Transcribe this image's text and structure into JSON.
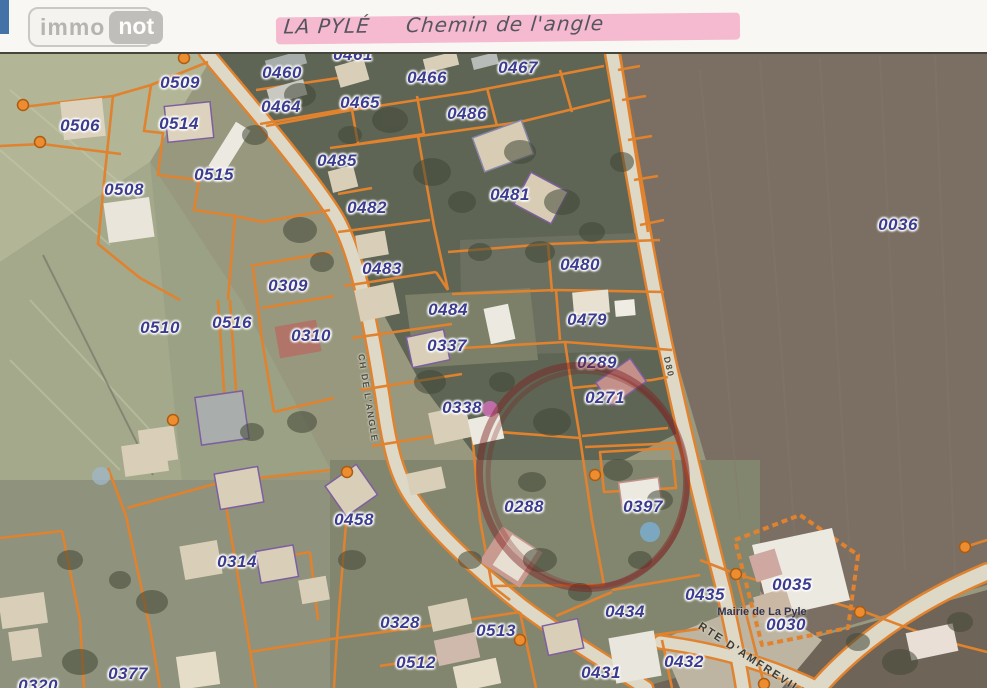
{
  "header": {
    "logo_immo": "immo",
    "logo_not": "not",
    "handwriting_left": "LA PYLÉ",
    "handwriting_right": "Chemin de l'angle"
  },
  "map": {
    "parcel_labels": [
      {
        "id": "0461",
        "x": 353,
        "y": 55
      },
      {
        "id": "0509",
        "x": 180,
        "y": 83
      },
      {
        "id": "0460",
        "x": 282,
        "y": 73
      },
      {
        "id": "0464",
        "x": 281,
        "y": 107
      },
      {
        "id": "0506",
        "x": 80,
        "y": 126
      },
      {
        "id": "0514",
        "x": 179,
        "y": 124
      },
      {
        "id": "0465",
        "x": 360,
        "y": 103
      },
      {
        "id": "0466",
        "x": 427,
        "y": 78
      },
      {
        "id": "0467",
        "x": 518,
        "y": 68
      },
      {
        "id": "0486",
        "x": 467,
        "y": 114
      },
      {
        "id": "0485",
        "x": 337,
        "y": 161
      },
      {
        "id": "0515",
        "x": 214,
        "y": 175
      },
      {
        "id": "0508",
        "x": 124,
        "y": 190
      },
      {
        "id": "0482",
        "x": 367,
        "y": 208
      },
      {
        "id": "0481",
        "x": 510,
        "y": 195
      },
      {
        "id": "0483",
        "x": 382,
        "y": 269
      },
      {
        "id": "0480",
        "x": 580,
        "y": 265
      },
      {
        "id": "0309",
        "x": 288,
        "y": 286
      },
      {
        "id": "0484",
        "x": 448,
        "y": 310
      },
      {
        "id": "0479",
        "x": 587,
        "y": 320
      },
      {
        "id": "0510",
        "x": 160,
        "y": 328
      },
      {
        "id": "0516",
        "x": 232,
        "y": 323
      },
      {
        "id": "0310",
        "x": 311,
        "y": 336
      },
      {
        "id": "0337",
        "x": 447,
        "y": 346
      },
      {
        "id": "0289",
        "x": 597,
        "y": 363
      },
      {
        "id": "0271",
        "x": 605,
        "y": 398
      },
      {
        "id": "0338",
        "x": 462,
        "y": 408
      },
      {
        "id": "0036",
        "x": 898,
        "y": 225
      },
      {
        "id": "0288",
        "x": 524,
        "y": 507
      },
      {
        "id": "0397",
        "x": 643,
        "y": 507
      },
      {
        "id": "0458",
        "x": 354,
        "y": 520
      },
      {
        "id": "0314",
        "x": 237,
        "y": 562
      },
      {
        "id": "0435",
        "x": 705,
        "y": 595
      },
      {
        "id": "0035",
        "x": 792,
        "y": 585
      },
      {
        "id": "0434",
        "x": 625,
        "y": 612
      },
      {
        "id": "0030",
        "x": 786,
        "y": 625
      },
      {
        "id": "0328",
        "x": 400,
        "y": 623
      },
      {
        "id": "0513",
        "x": 496,
        "y": 631
      },
      {
        "id": "0432",
        "x": 684,
        "y": 662
      },
      {
        "id": "0512",
        "x": 416,
        "y": 663
      },
      {
        "id": "0431",
        "x": 601,
        "y": 673
      },
      {
        "id": "0377",
        "x": 128,
        "y": 674
      },
      {
        "id": "0320",
        "x": 38,
        "y": 686
      }
    ],
    "road_labels": [
      {
        "text": "CH DE L'ANGLE",
        "x": 368,
        "y": 398,
        "rotate": 81,
        "big": false
      },
      {
        "text": "D80",
        "x": 669,
        "y": 367,
        "rotate": 77,
        "big": false
      },
      {
        "text": "RTE D'AMFREVILLE",
        "x": 757,
        "y": 663,
        "rotate": 33,
        "big": true
      }
    ],
    "poi_labels": [
      {
        "text": "Mairie de La Pyle",
        "x": 762,
        "y": 612
      }
    ],
    "vertex_dots": [
      [
        184,
        58
      ],
      [
        23,
        105
      ],
      [
        40,
        142
      ],
      [
        173,
        420
      ],
      [
        595,
        475
      ],
      [
        520,
        640
      ],
      [
        736,
        574
      ],
      [
        860,
        612
      ],
      [
        965,
        547
      ],
      [
        764,
        684
      ],
      [
        347,
        472
      ]
    ],
    "annotations": {
      "red_circle": {
        "cx": 583,
        "cy": 477,
        "rx": 103,
        "ry": 112,
        "rotate": -14,
        "color": "#7e1f1f"
      },
      "pink_dot": {
        "cx": 490,
        "cy": 409,
        "r": 8,
        "color": "#cf6fb5"
      },
      "highlight_color": "#f4a9c4"
    },
    "colors": {
      "boundary_orange": "#e0822e",
      "label_blue": "#3c3c8e",
      "dot_fill": "#ee8d30",
      "dot_stroke": "#aa5c12",
      "road_fill": "#ded8c6"
    }
  }
}
